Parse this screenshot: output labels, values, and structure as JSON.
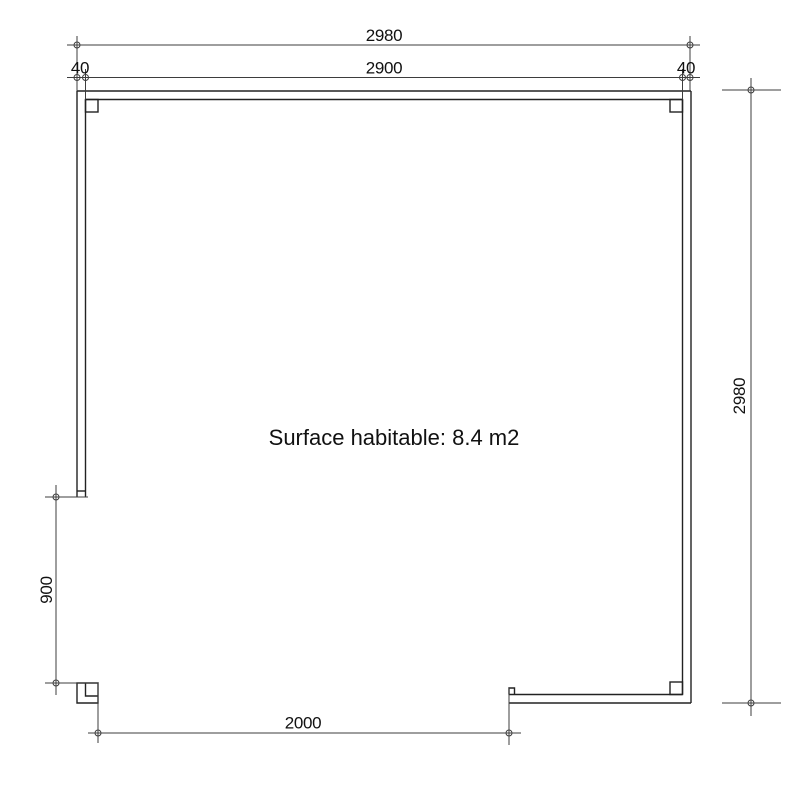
{
  "plan": {
    "area_label": "Surface habitable: 8.4 m2",
    "dim_overall_width": "2980",
    "dim_inner_width": "2900",
    "dim_wall_thickness_left": "40",
    "dim_wall_thickness_right": "40",
    "dim_overall_depth": "2980",
    "dim_side_opening": "900",
    "dim_front_opening": "2000"
  },
  "colors": {
    "background": "#ffffff",
    "line": "#222222",
    "dim": "#3d3d3d",
    "text": "#111111"
  }
}
